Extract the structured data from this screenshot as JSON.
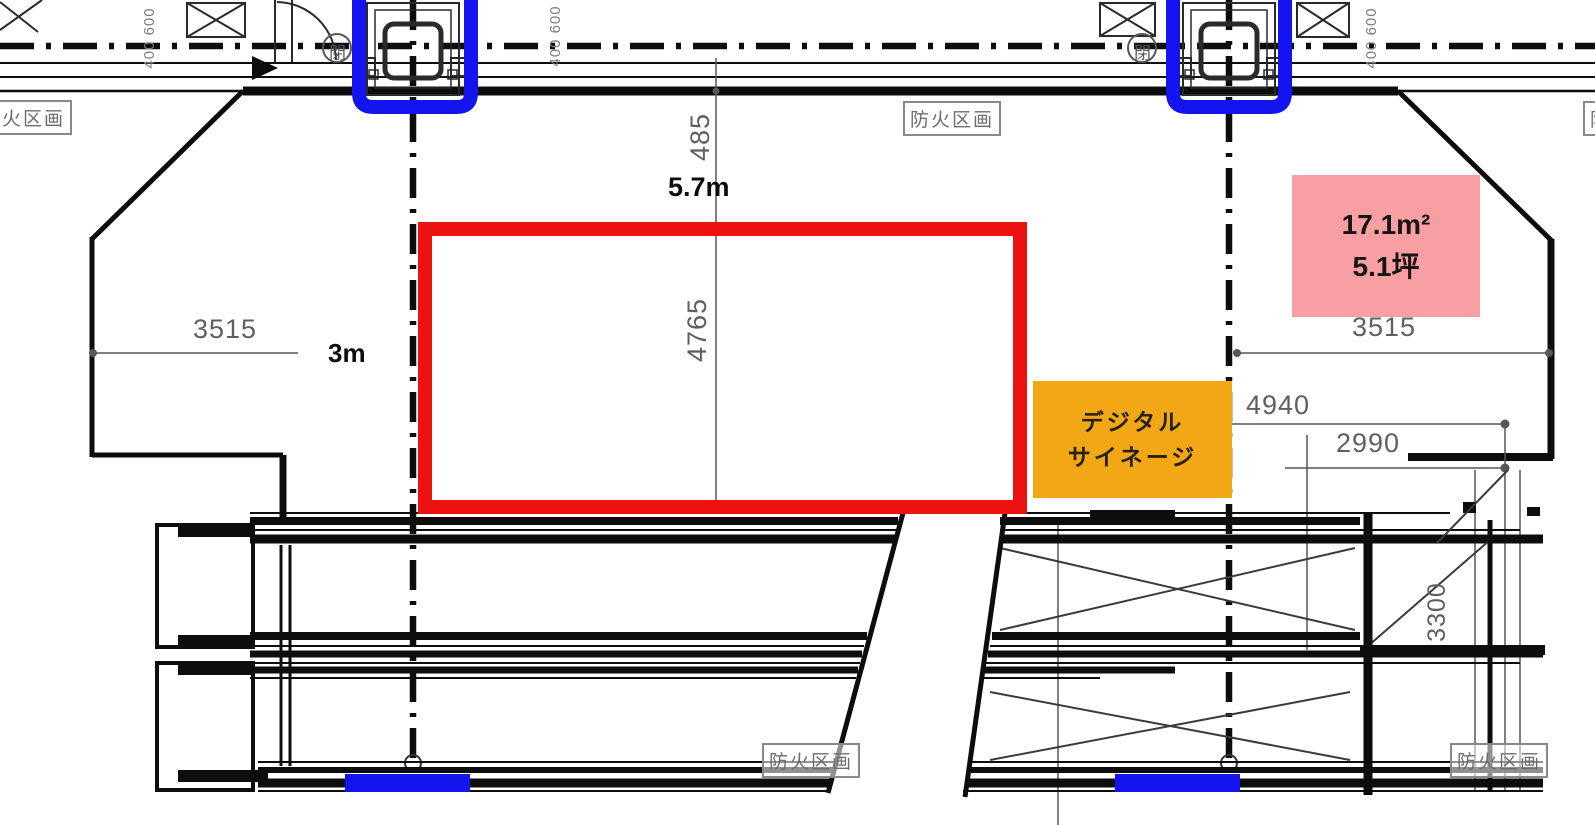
{
  "labels": {
    "fire_zone": "防火区画",
    "width_label": "5.7m",
    "depth_label": "3m",
    "close_mark": "閉"
  },
  "dimensions": {
    "d485": "485",
    "d4765": "4765",
    "d3515_left": "3515",
    "d3515_right": "3515",
    "d4940": "4940",
    "d2990": "2990",
    "d3300": "3300",
    "d400_600": "400 600"
  },
  "area_box": {
    "area_m2": "17.1m²",
    "area_tsubo": "5.1坪"
  },
  "signage_box": {
    "line1": "デジタル",
    "line2": "サイネージ"
  },
  "colors": {
    "event_space_outline": "#ee1111",
    "elevator_marker": "#1414ee",
    "signage_fill": "#f2a714",
    "area_fill": "#f79fa3",
    "dim_text": "#5d5f63",
    "cad_line": "#0d0d0d"
  }
}
